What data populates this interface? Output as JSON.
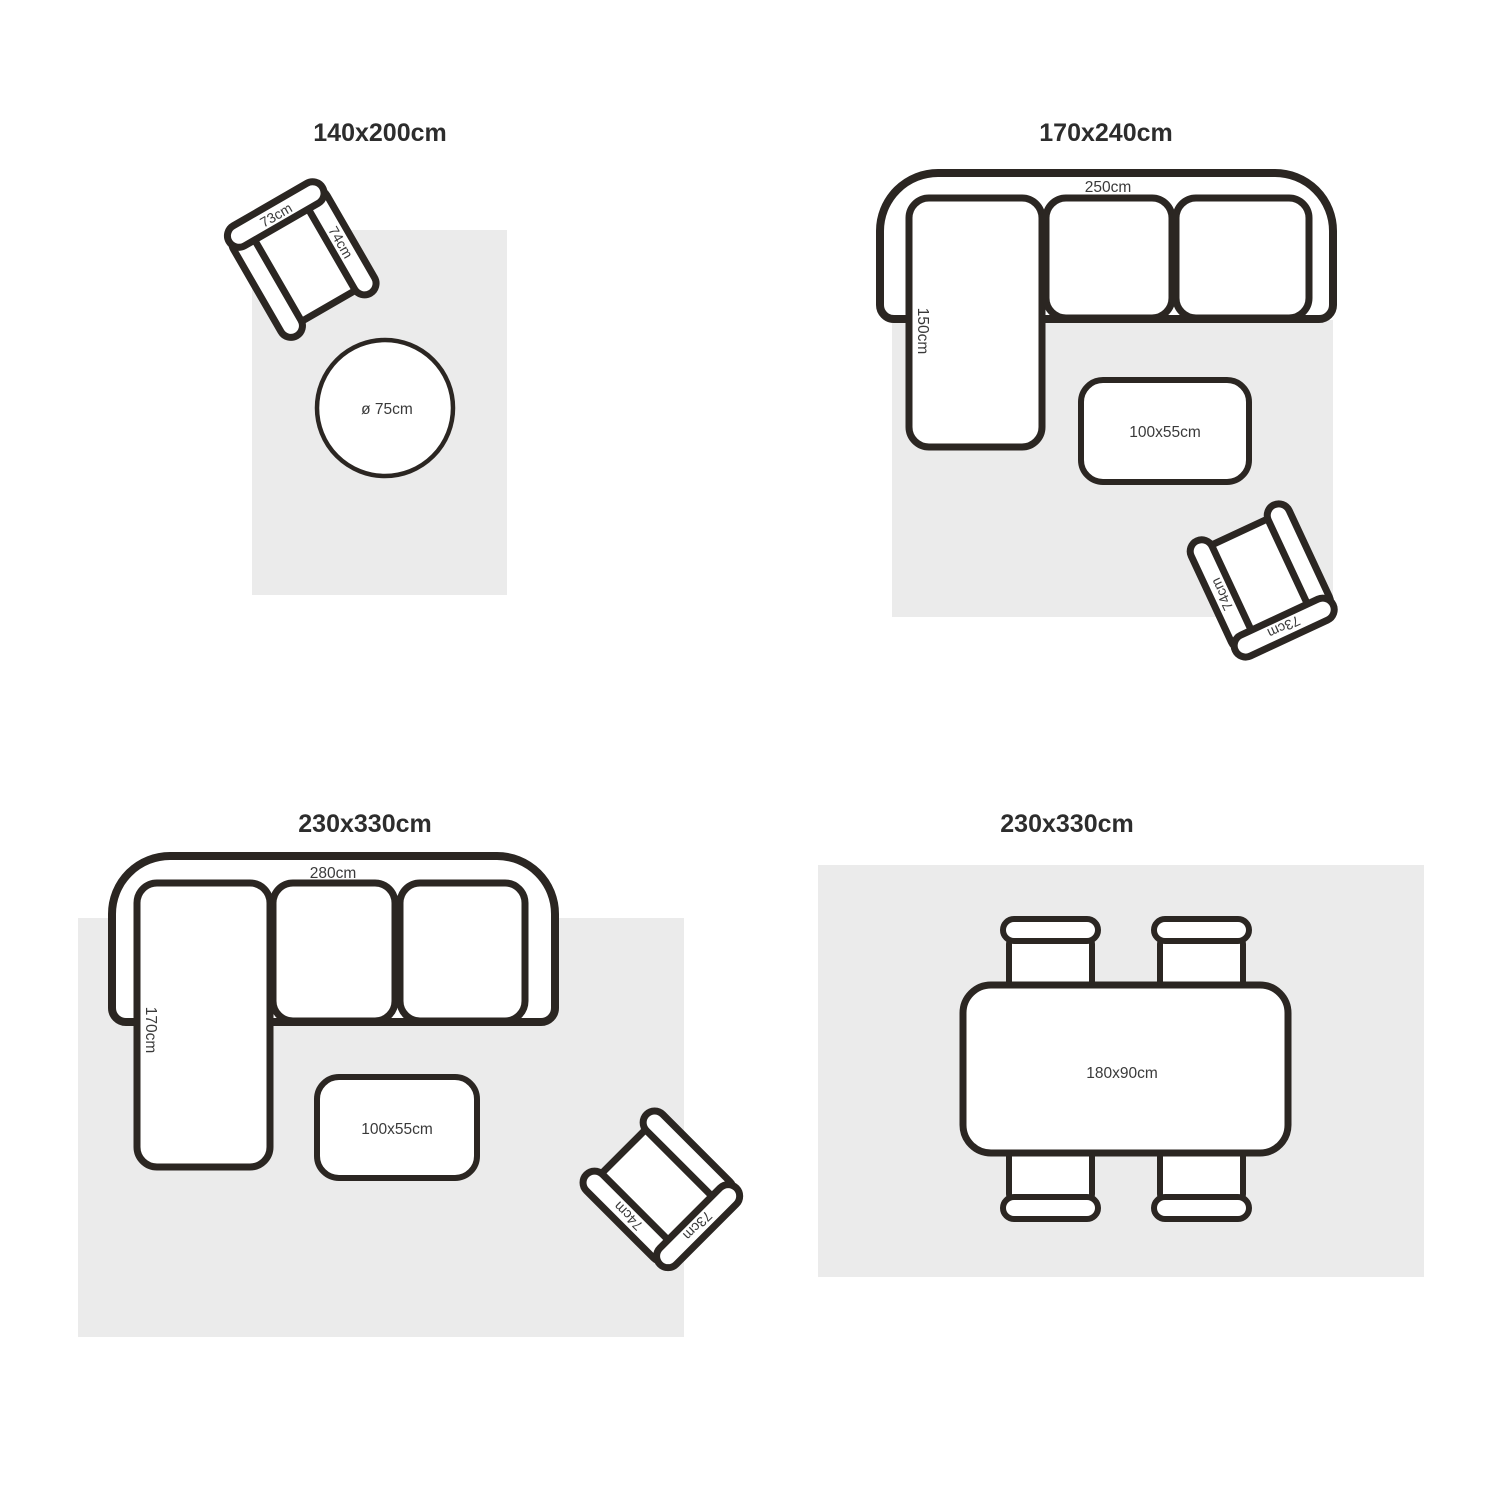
{
  "colors": {
    "background": "#ffffff",
    "outline": "#2b2622",
    "rug_fill": "#ebebeb",
    "title_text": "#2d2d2d",
    "dimension_text": "#3a3a3a"
  },
  "armchair": {
    "back_label": "73cm",
    "arm_label": "74cm"
  },
  "quadrants": {
    "tl": {
      "title": "140x200cm",
      "round_table_label": "ø 75cm"
    },
    "tr": {
      "title": "170x240cm",
      "sofa_width_label": "250cm",
      "sofa_chaise_label": "150cm",
      "coffee_table_label": "100x55cm"
    },
    "bl": {
      "title": "230x330cm",
      "sofa_width_label": "280cm",
      "sofa_chaise_label": "170cm",
      "coffee_table_label": "100x55cm"
    },
    "br": {
      "title": "230x330cm",
      "dining_table_label": "180x90cm"
    }
  }
}
